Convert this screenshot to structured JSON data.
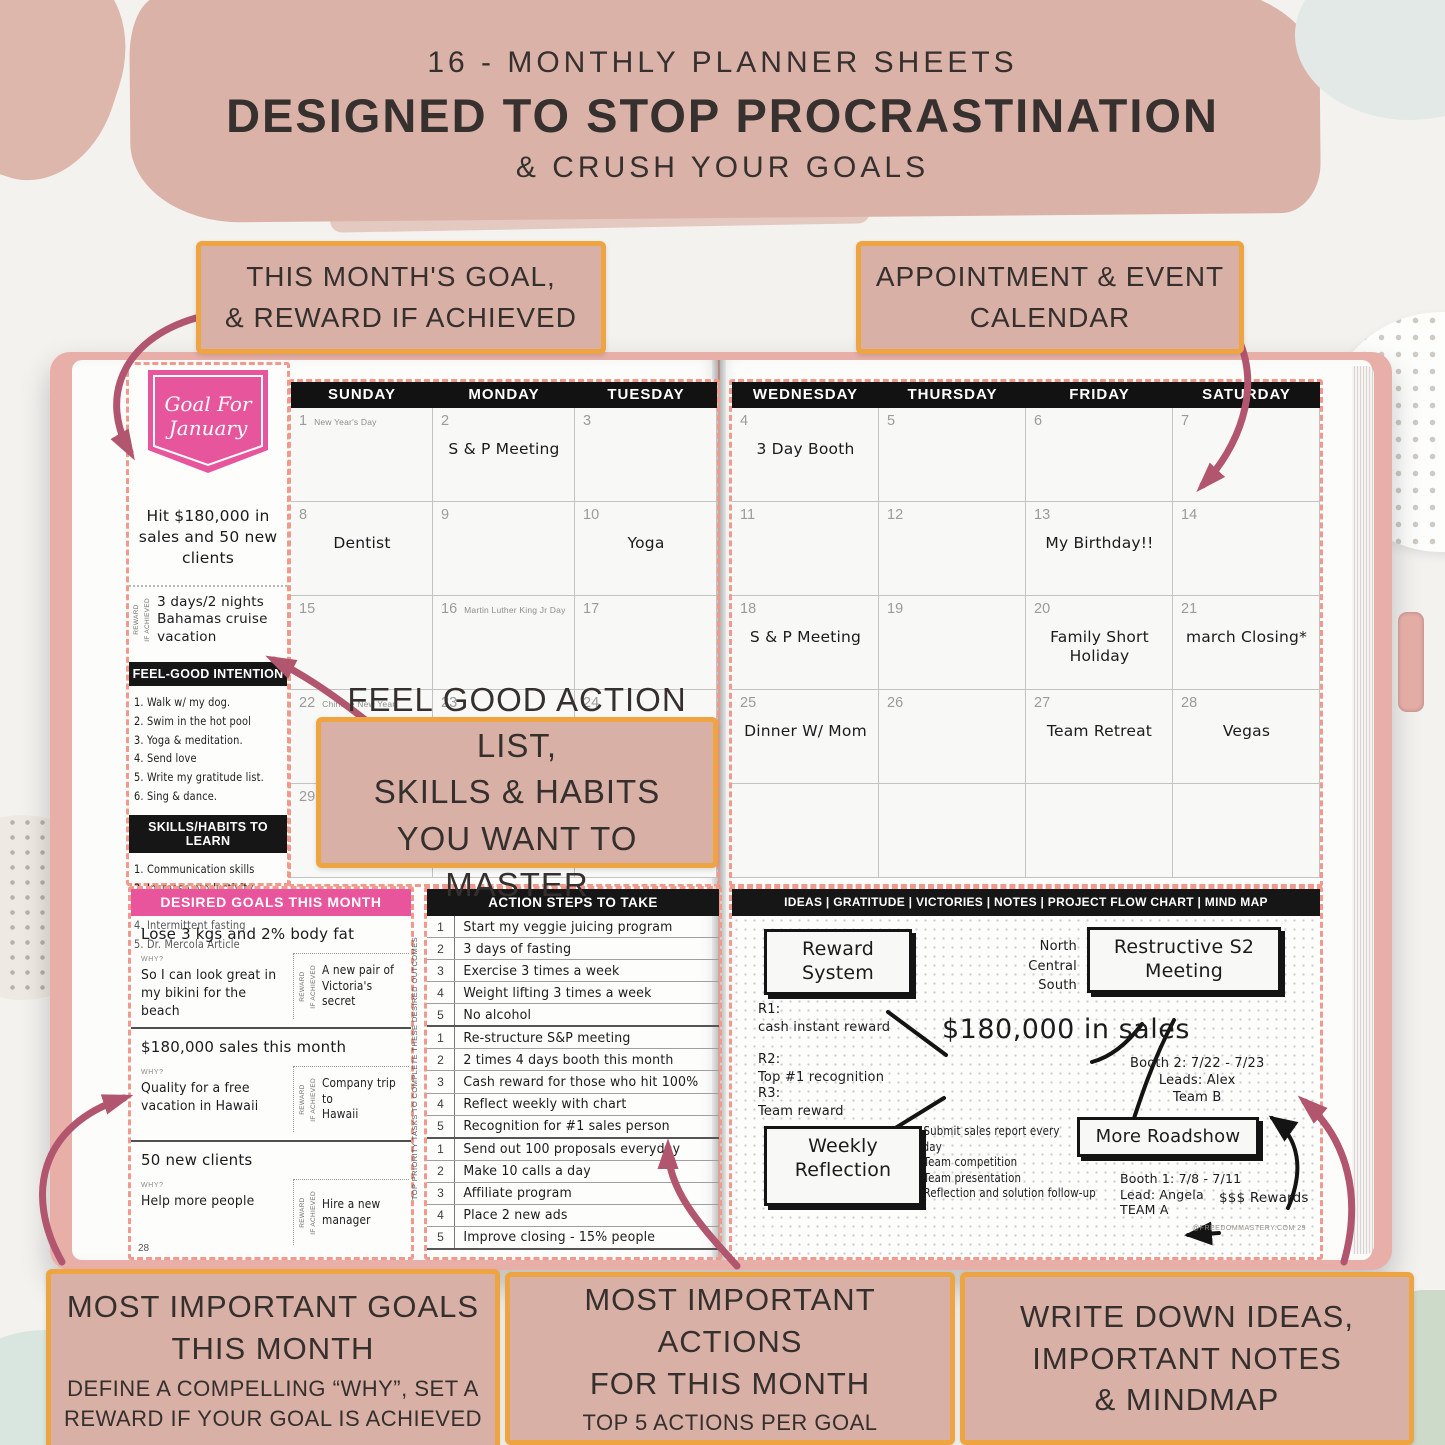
{
  "header": {
    "line1": "16 - MONTHLY PLANNER SHEETS",
    "line2": "DESIGNED TO STOP PROCRASTINATION",
    "line3": "& CRUSH YOUR GOALS"
  },
  "callouts": {
    "month_goal": "THIS MONTH'S GOAL,\n& REWARD IF ACHIEVED",
    "appointment": "APPOINTMENT & EVENT\nCALENDAR",
    "feel_good": "FEEL GOOD ACTION LIST,\nSKILLS & HABITS\nYOU WANT TO MASTER",
    "important_goals_title": "MOST IMPORTANT GOALS\nTHIS MONTH",
    "important_goals_sub": "DEFINE A COMPELLING “WHY”, SET A\nREWARD IF YOUR GOAL IS ACHIEVED",
    "important_actions_title": "MOST IMPORTANT ACTIONS\nFOR THIS MONTH",
    "important_actions_sub": "TOP 5 ACTIONS PER GOAL",
    "write_down": "WRITE DOWN IDEAS,\nIMPORTANT NOTES\n& MINDMAP"
  },
  "sidebar": {
    "badge": "Goal For\nJanuary",
    "goal": "Hit $180,000 in\nsales and 50 new\nclients",
    "reward_label": "REWARD\nIF ACHIEVED",
    "reward": "3 days/2 nights\nBahamas cruise\nvacation",
    "feel_good_header": "FEEL-GOOD INTENTION",
    "feel_good_items": [
      "1. Walk w/ my dog.",
      "2. Swim in the hot pool",
      "3. Yoga & meditation.",
      "4. Send love",
      "5. Write my gratitude list.",
      "6. Sing & dance."
    ],
    "skills_header": "SKILLS/HABITS TO LEARN",
    "skills_items": [
      "1. Communication skills",
      "2. Increase productivity",
      "3. Healthy home cooking",
      "4. Intermittent fasting",
      "5. Dr. Mercola Article"
    ]
  },
  "calendar": {
    "left_days": [
      "SUNDAY",
      "MONDAY",
      "TUESDAY"
    ],
    "right_days": [
      "WEDNESDAY",
      "THURSDAY",
      "FRIDAY",
      "SATURDAY"
    ],
    "left_cells": [
      {
        "num": "1",
        "note": "New Year's Day",
        "entry": ""
      },
      {
        "num": "2",
        "note": "",
        "entry": "S & P Meeting"
      },
      {
        "num": "3",
        "note": "",
        "entry": ""
      },
      {
        "num": "8",
        "note": "",
        "entry": "Dentist"
      },
      {
        "num": "9",
        "note": "",
        "entry": ""
      },
      {
        "num": "10",
        "note": "",
        "entry": "Yoga"
      },
      {
        "num": "15",
        "note": "",
        "entry": ""
      },
      {
        "num": "16",
        "note": "Martin Luther King Jr Day",
        "entry": ""
      },
      {
        "num": "17",
        "note": "",
        "entry": ""
      },
      {
        "num": "22",
        "note": "Chinese New Year",
        "entry": ""
      },
      {
        "num": "23",
        "note": "",
        "entry": ""
      },
      {
        "num": "24",
        "note": "",
        "entry": ""
      },
      {
        "num": "29",
        "note": "",
        "entry": ""
      },
      {
        "num": "30",
        "note": "",
        "entry": ""
      },
      {
        "num": "31",
        "note": "",
        "entry": ""
      }
    ],
    "right_cells": [
      {
        "num": "4",
        "note": "",
        "entry": "3 Day Booth"
      },
      {
        "num": "5",
        "note": "",
        "entry": ""
      },
      {
        "num": "6",
        "note": "",
        "entry": ""
      },
      {
        "num": "7",
        "note": "",
        "entry": ""
      },
      {
        "num": "11",
        "note": "",
        "entry": ""
      },
      {
        "num": "12",
        "note": "",
        "entry": ""
      },
      {
        "num": "13",
        "note": "",
        "entry": "My Birthday!!"
      },
      {
        "num": "14",
        "note": "",
        "entry": ""
      },
      {
        "num": "18",
        "note": "",
        "entry": "S & P Meeting"
      },
      {
        "num": "19",
        "note": "",
        "entry": ""
      },
      {
        "num": "20",
        "note": "",
        "entry": "Family Short\nHoliday"
      },
      {
        "num": "21",
        "note": "",
        "entry": "march Closing*"
      },
      {
        "num": "25",
        "note": "",
        "entry": "Dinner W/ Mom"
      },
      {
        "num": "26",
        "note": "",
        "entry": ""
      },
      {
        "num": "27",
        "note": "",
        "entry": "Team Retreat"
      },
      {
        "num": "28",
        "note": "",
        "entry": "Vegas"
      },
      {
        "num": "",
        "note": "",
        "entry": ""
      },
      {
        "num": "",
        "note": "",
        "entry": ""
      },
      {
        "num": "",
        "note": "",
        "entry": ""
      },
      {
        "num": "",
        "note": "",
        "entry": ""
      }
    ]
  },
  "goals_section": {
    "header": "DESIRED GOALS THIS MONTH",
    "why_label": "WHY?",
    "reward_label": "REWARD\nIF ACHIEVED",
    "items": [
      {
        "goal": "Lose 3 kgs and 2% body fat",
        "why": "So I can look great in\nmy bikini for the beach",
        "reward": "A new pair of\nVictoria's secret"
      },
      {
        "goal": "$180,000 sales this month",
        "why": "Quality for a free\nvacation in Hawaii",
        "reward": "Company trip to\nHawaii"
      },
      {
        "goal": "50 new clients",
        "why": "Help more people",
        "reward": "Hire a new\nmanager"
      }
    ],
    "page_number": "28"
  },
  "priority_strip": "TOP PRIORITY TASKS TO COMPLETE THESE DESIRED OUTCOMES",
  "actions_section": {
    "header": "ACTION STEPS TO TAKE",
    "items": [
      {
        "n": "1",
        "text": "Start my veggie juicing program"
      },
      {
        "n": "2",
        "text": "3 days of fasting"
      },
      {
        "n": "3",
        "text": "Exercise 3 times a week"
      },
      {
        "n": "4",
        "text": "Weight lifting 3 times a week"
      },
      {
        "n": "5",
        "text": "No alcohol"
      },
      {
        "n": "1",
        "text": "Re-structure S&P meeting"
      },
      {
        "n": "2",
        "text": "2 times 4 days booth this month"
      },
      {
        "n": "3",
        "text": "Cash reward for those who hit 100%"
      },
      {
        "n": "4",
        "text": "Reflect weekly with chart"
      },
      {
        "n": "5",
        "text": "Recognition for #1 sales person"
      },
      {
        "n": "1",
        "text": "Send out 100 proposals everyday"
      },
      {
        "n": "2",
        "text": "Make 10 calls a day"
      },
      {
        "n": "3",
        "text": "Affiliate program"
      },
      {
        "n": "4",
        "text": "Place 2 new ads"
      },
      {
        "n": "5",
        "text": "Improve closing - 15% people"
      }
    ]
  },
  "mindmap": {
    "header": "IDEAS | GRATITUDE | VICTORIES | NOTES | PROJECT FLOW CHART | MIND MAP",
    "reward_system_box": "Reward\nSystem",
    "restructive_box": "Restructive S2\nMeeting",
    "weekly_box": "Weekly\nReflection",
    "roadshow_box": "More Roadshow",
    "regions": "North\nCentral\nSouth",
    "r1": "R1:\ncash instant reward",
    "r2": "R2:\n Top #1 recognition",
    "r3": "R3:\n Team reward",
    "center": "$180,000 in sales",
    "booth2": "Booth 2: 7/22 - 7/23\nLeads: Alex\nTeam B",
    "weekly_list": "1. Submit sales report every\n              Friday\n2. Team competition\n3. Team presentation\n4. Reflection and solution follow-up",
    "booth1": "Booth 1: 7/8 - 7/11\nLead: Angela\nTEAM A",
    "rewards": "$$$ Rewards",
    "footer": "@FREEDOMMASTERY.COM  29"
  },
  "colors": {
    "brush_pink": "#dbb2a8",
    "callout_bg": "#d9b0a6",
    "callout_border": "#eea440",
    "magenta": "#e8559c",
    "dashed_salmon": "#f09a8e",
    "arrow_rose": "#b2556e",
    "bar_black": "#161616",
    "cover_rose": "#e7afa7"
  }
}
